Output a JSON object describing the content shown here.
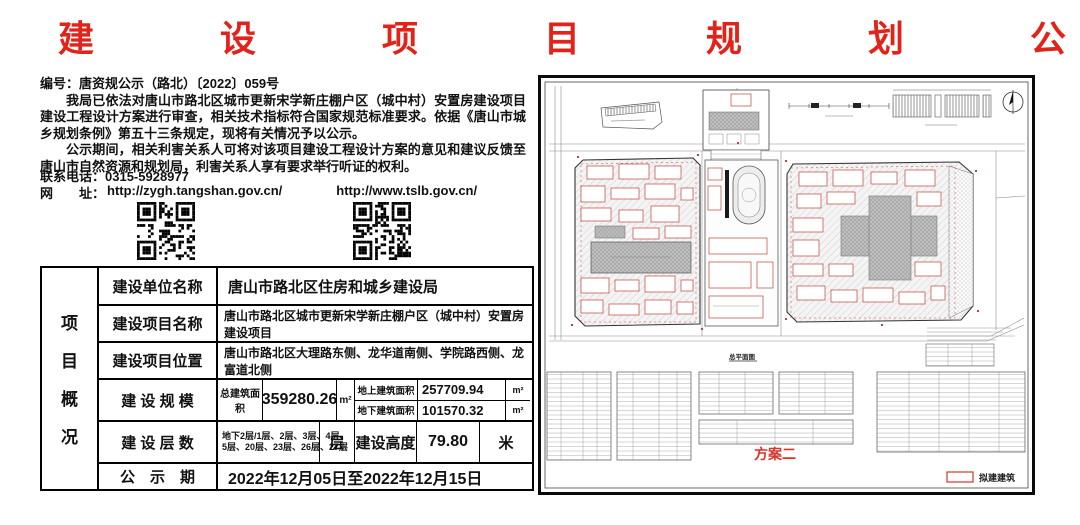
{
  "title": "建 设 项 目 规 划 公 示",
  "notice": {
    "doc_no": "编号：唐资规公示（路北）〔2022〕059号",
    "para1": "我局已依法对唐山市路北区城市更新宋学新庄棚户区（城中村）安置房建设项目建设工程设计方案进行审查，相关技术指标符合国家规范标准要求。依据《唐山市城乡规划条例》第五十三条规定，现将有关情况予以公示。",
    "para2": "公示期间，相关利害关系人可将对该项目建设工程设计方案的意见和建议反馈至唐山市自然资源和规划局，利害关系人享有要求举行听证的权利。",
    "phone": "联系电话：0315-5928977",
    "web_label": "网　　址：",
    "url1": "http://zygh.tangshan.gov.cn/",
    "url2": "http://www.tslb.gov.cn/"
  },
  "table": {
    "side_header": [
      "项",
      "目",
      "概",
      "况"
    ],
    "r1_label": "建设单位名称",
    "r1_value": "唐山市路北区住房和城乡建设局",
    "r2_label": "建设项目名称",
    "r2_value": "唐山市路北区城市更新宋学新庄棚户区（城中村）安置房建设项目",
    "r3_label": "建设项目位置",
    "r3_value": "唐山市路北区大理路东侧、龙华道南侧、学院路西侧、龙富道北侧",
    "r4_label": "建 设 规 模",
    "r4_total_label": "总建筑面积",
    "r4_total_value": "359280.26",
    "r4_total_unit": "m²",
    "r4_above_label": "地上建筑面积",
    "r4_above_value": "257709.94",
    "r4_above_unit": "m²",
    "r4_below_label": "地下建筑面积",
    "r4_below_value": "101570.32",
    "r4_below_unit": "m²",
    "r5_label": "建 设 层 数",
    "r5_floors_line1": "地下2层/1层、2层、3层、4层、",
    "r5_floors_line2": "5层、20层、23层、26层、27层",
    "r5_floors_unit": "层",
    "r5_height_label": "建设高度",
    "r5_height_value": "79.80",
    "r5_height_unit": "米",
    "r6_label": "公　示　期",
    "r6_value": "2022年12月05日至2022年12月15日"
  },
  "site_plan": {
    "drawing_title": "总平面图",
    "plan_label": "方案二",
    "legend_label": "拟建建筑",
    "accent_red": "#d9342b",
    "building_outline": "#c0453a"
  }
}
